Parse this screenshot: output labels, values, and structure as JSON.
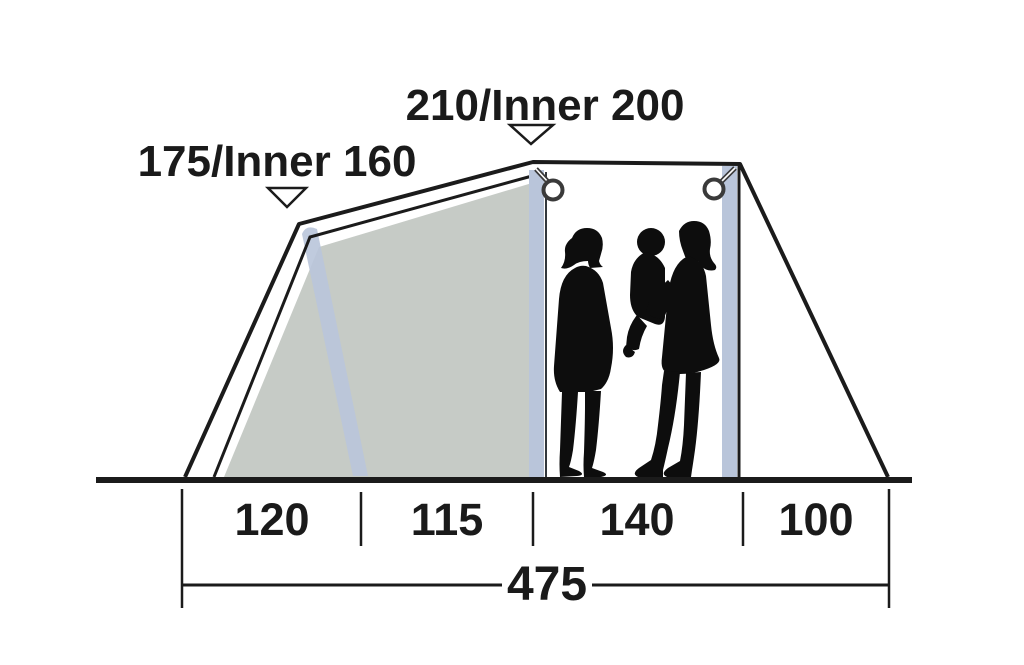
{
  "diagram": {
    "title": "tent-side-elevation-dimensions",
    "peak_labels": {
      "left": "175/Inner 160",
      "main": "210/Inner 200"
    },
    "floor_segments": [
      {
        "value": "120"
      },
      {
        "value": "115"
      },
      {
        "value": "140"
      },
      {
        "value": "100"
      }
    ],
    "total_length": {
      "value": "475"
    },
    "units": "cm",
    "colors": {
      "outline": "#1b1b1b",
      "inner_panel": "#c6cbc6",
      "pole": "#b9c5da",
      "silhouette": "#0d0d0d",
      "ring_fill": "#ffffff",
      "background": "#ffffff"
    }
  }
}
